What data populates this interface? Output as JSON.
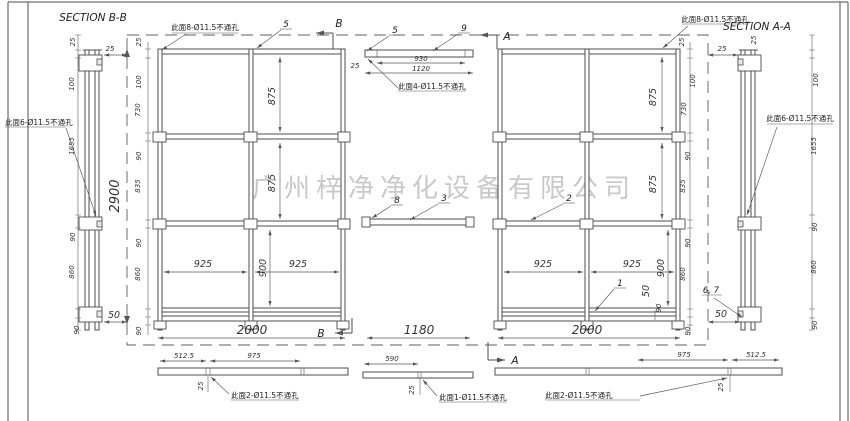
{
  "watermark": "广州梓净净化设备有限公司",
  "titles": {
    "section_bb": "SECTION B-B",
    "section_aa": "SECTION A-A"
  },
  "section_marks": {
    "b_top": "B",
    "a_top": "A",
    "b_bottom": "B",
    "a_bottom": "A"
  },
  "callouts": {
    "c5_left": "5",
    "c5_mid": "5",
    "c9": "9",
    "c8": "8",
    "c3": "3",
    "c2": "2",
    "c1": "1",
    "c67": "6, 7"
  },
  "leaders": {
    "tl8": "此面8-Ø11.5不通孔",
    "tr8": "此面8-Ø11.5不通孔",
    "l6": "此面6-Ø11.5不通孔",
    "r6": "此面6-Ø11.5不通孔",
    "m4": "此面4-Ø11.5不通孔",
    "bl2": "此面2-Ø11.5不通孔",
    "bm1": "此面1-Ø11.5不通孔",
    "br2": "此面2-Ø11.5不通孔"
  },
  "dims": {
    "sec_b": {
      "d25t": "25",
      "d25h": "25",
      "d100": "100",
      "d1655": "1655",
      "d90a": "90",
      "d860": "860",
      "d90b": "90",
      "d50": "50",
      "d2900": "2900"
    },
    "lf": {
      "d25t": "25",
      "d100": "100",
      "d730": "730",
      "d90a": "90",
      "d835": "835",
      "d90b": "90",
      "d860": "860",
      "d90c": "90",
      "row1": "875",
      "row2": "875",
      "row3": "900",
      "col1": "925",
      "col2": "925",
      "width": "2000"
    },
    "mid": {
      "d930": "930",
      "d1120": "1120",
      "d25": "25",
      "gap": "1180"
    },
    "rf": {
      "d25t": "25",
      "d25h": "25",
      "d100": "100",
      "d730": "730",
      "d90a": "90",
      "d835": "835",
      "d90b": "90",
      "d860": "860",
      "d90c": "90",
      "d90d": "90",
      "row1": "875",
      "row2": "875",
      "row3": "900",
      "d50": "50",
      "col1": "925",
      "col2": "925",
      "width": "2000"
    },
    "sec_a": {
      "d25t": "25",
      "d100": "100",
      "d1655": "1655",
      "d90a": "90",
      "d860": "860",
      "d90b": "90",
      "d50": "50"
    },
    "strip_l": {
      "a": "512.5",
      "b": "975",
      "c": "25"
    },
    "strip_m": {
      "a": "590",
      "c": "25"
    },
    "strip_r": {
      "a": "975",
      "b": "512.5",
      "c": "25"
    }
  }
}
